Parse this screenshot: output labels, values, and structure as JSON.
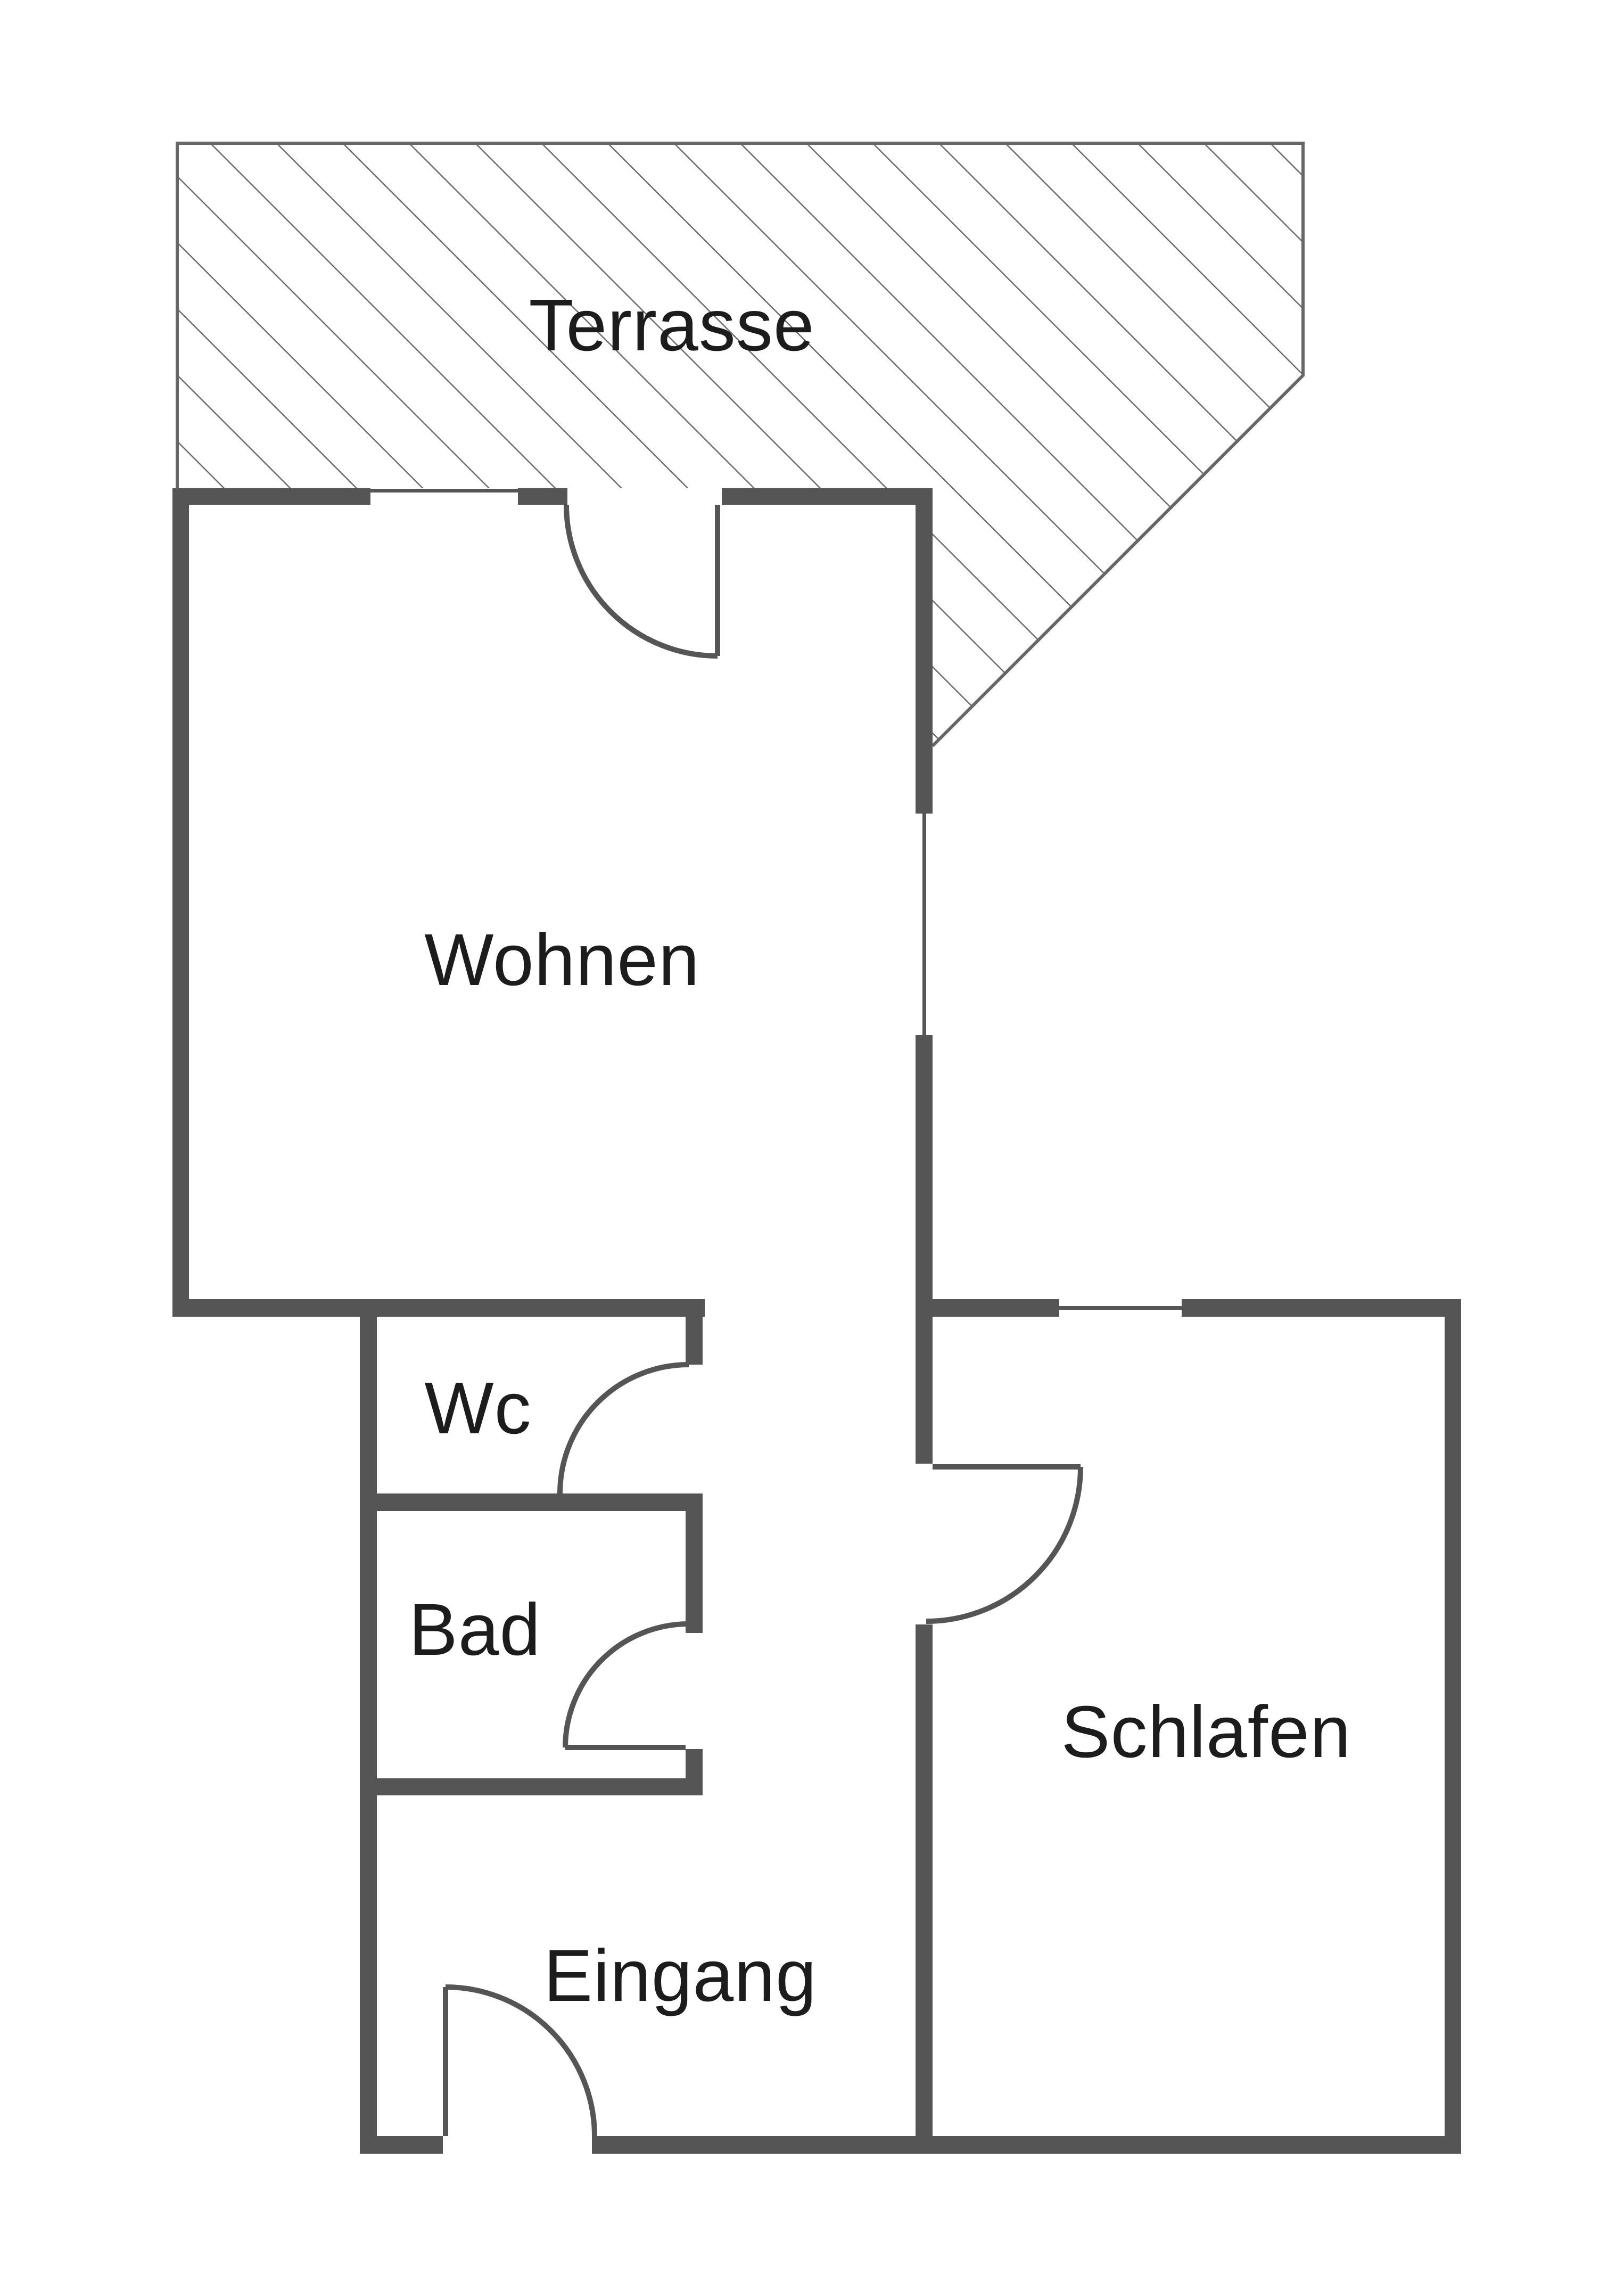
{
  "plan": {
    "background_color": "#ffffff",
    "wall_color": "#555555",
    "thin_line_color": "#666666",
    "text_color": "#1c1c1c",
    "rooms": [
      {
        "id": "terrasse",
        "label": "Terrasse"
      },
      {
        "id": "wohnen",
        "label": "Wohnen"
      },
      {
        "id": "wc",
        "label": "Wc"
      },
      {
        "id": "bad",
        "label": "Bad"
      },
      {
        "id": "schlafen",
        "label": "Schlafen"
      },
      {
        "id": "eingang",
        "label": "Eingang"
      }
    ],
    "features": {
      "door_count": 5,
      "window_count": 3,
      "terrace_hatched": true
    }
  }
}
